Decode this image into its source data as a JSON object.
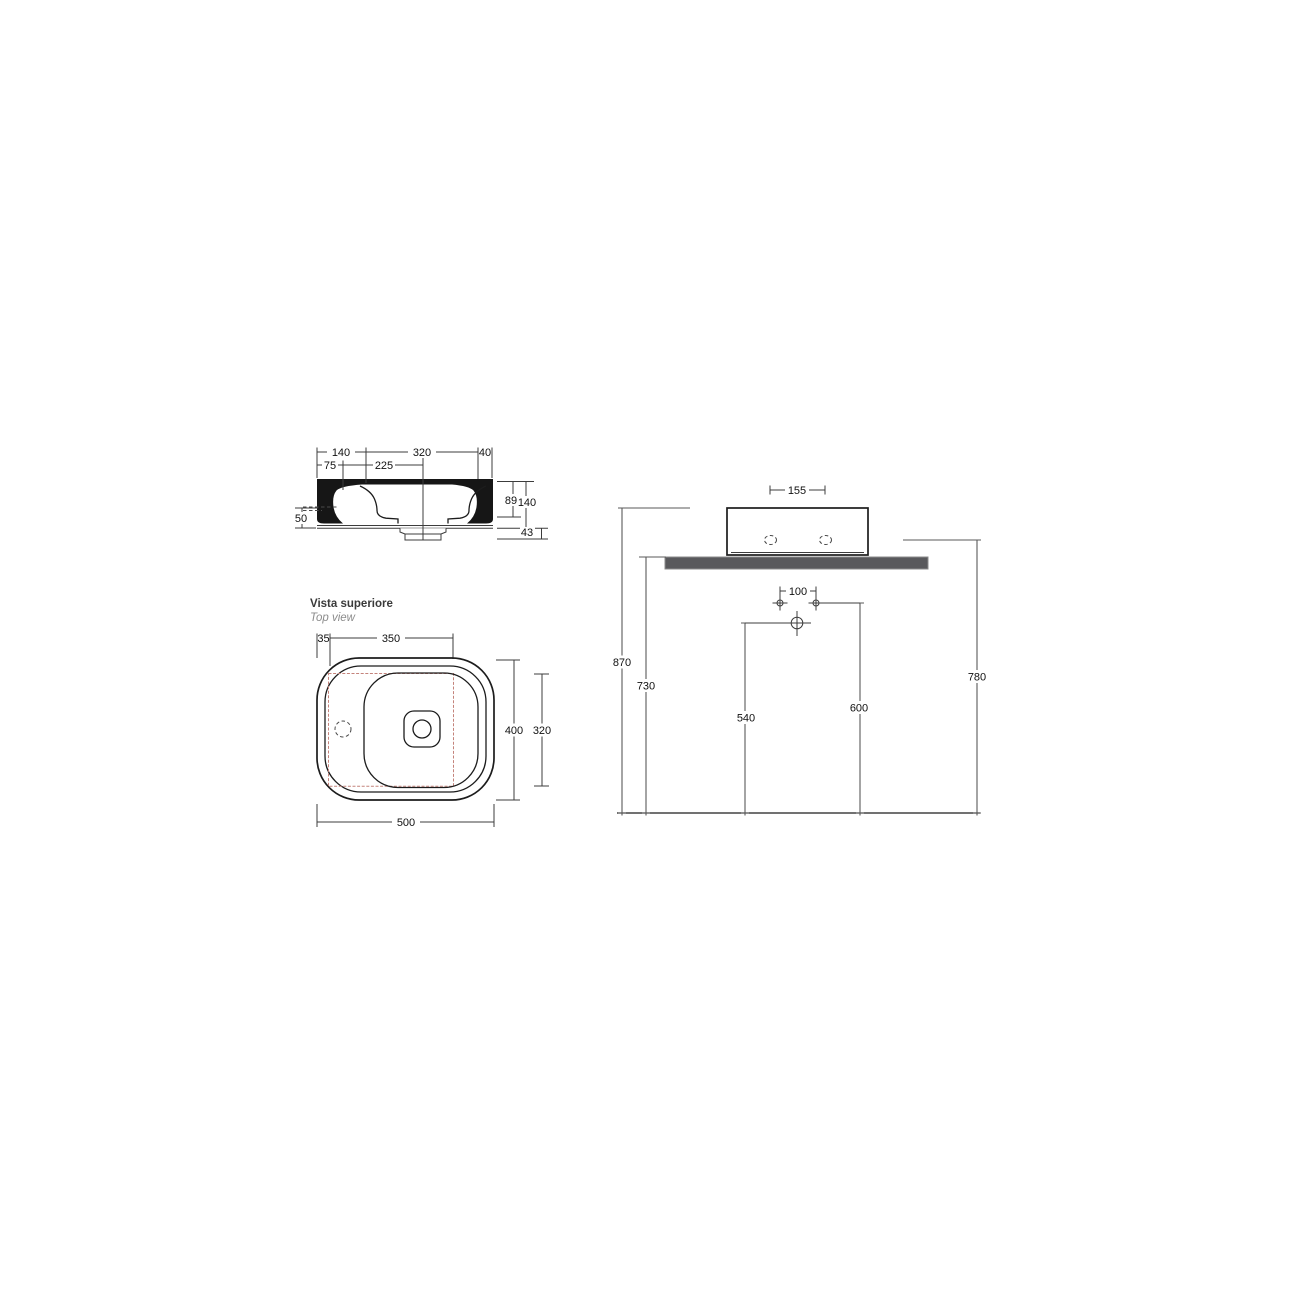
{
  "section_view": {
    "dims": {
      "top_140": "140",
      "top_320": "320",
      "top_40": "40",
      "row2_75": "75",
      "row2_225": "225",
      "left_50": "50",
      "right_89": "89",
      "right_140": "140",
      "bottom_43": "43"
    }
  },
  "top_view": {
    "title": "Vista superiore",
    "subtitle": "Top view",
    "dims": {
      "top_35": "35",
      "top_350": "350",
      "right_400": "400",
      "right_320": "320",
      "bottom_500": "500"
    }
  },
  "installation_view": {
    "dims": {
      "top_155": "155",
      "holes_100": "100",
      "left_870": "870",
      "left_730": "730",
      "mid_540": "540",
      "mid_600": "600",
      "right_780": "780"
    }
  },
  "colors": {
    "line": "#1c1c1c",
    "dimension": "#3c3c3c",
    "accent_red": "#c4837b",
    "countertop_fill": "#59595c",
    "countertop_stroke": "#8b8b8b",
    "subtitle_gray": "#8c8c8c"
  }
}
